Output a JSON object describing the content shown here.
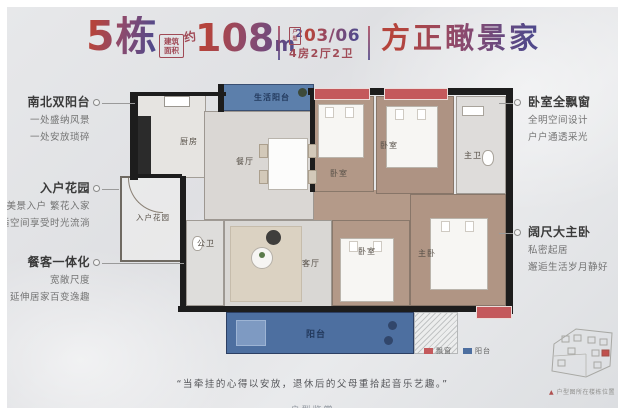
{
  "header": {
    "building": "5栋",
    "area_badge_line1": "建筑",
    "area_badge_line2": "面积",
    "area_approx": "约",
    "area_value": "108",
    "area_unit": "m",
    "area_sup": "2",
    "unit_icon_line1": "户",
    "unit_icon_line2": "型",
    "unit_number": "03/06",
    "unit_layout": "4房2厅2卫",
    "title": "方正瞰景家"
  },
  "annotations": {
    "left": [
      {
        "title": "南北双阳台",
        "lines": [
          "一处盛纳风景",
          "一处安放琐碎"
        ]
      },
      {
        "title": "入户花园",
        "lines": [
          "美景入户 繁花入家",
          "舒适空间享受时光流淌"
        ]
      },
      {
        "title": "餐客一体化",
        "lines": [
          "宽敞尺度",
          "延伸居家百变逸趣"
        ]
      }
    ],
    "right": [
      {
        "title": "卧室全飘窗",
        "lines": [
          "全明空间设计",
          "户户通透采光"
        ]
      },
      {
        "title": "阔尺大主卧",
        "lines": [
          "私密起居",
          "邂逅生活岁月静好"
        ]
      }
    ]
  },
  "floorplan": {
    "rooms": {
      "service_balcony": "生活阳台",
      "kitchen": "厨房",
      "dining": "餐厅",
      "entry_garden": "入户花园",
      "guest_bath": "公卫",
      "living": "客厅",
      "bedroom": "卧室",
      "master_bath": "主卫",
      "master_bedroom": "主卧",
      "balcony": "阳台"
    }
  },
  "legend": {
    "items": [
      {
        "label": "飘窗",
        "color": "#c4595c"
      },
      {
        "label": "阳台",
        "color": "#4d6fa0"
      }
    ]
  },
  "quote": "“当牵挂的心得以安放，退休后的父母重拾起音乐艺趣。”",
  "site_inset": {
    "marker": "▲",
    "caption": "户型图所在楼栋位置"
  },
  "footer_watermark": "户型鉴赏",
  "colors": {
    "accent_red": "#b5443c",
    "accent_purple": "#50498b",
    "bay_red": "#c4595c",
    "balcony_blue": "#4d6fa0",
    "service_balcony_blue": "#5c7fab",
    "wall": "#1d1d1d"
  }
}
